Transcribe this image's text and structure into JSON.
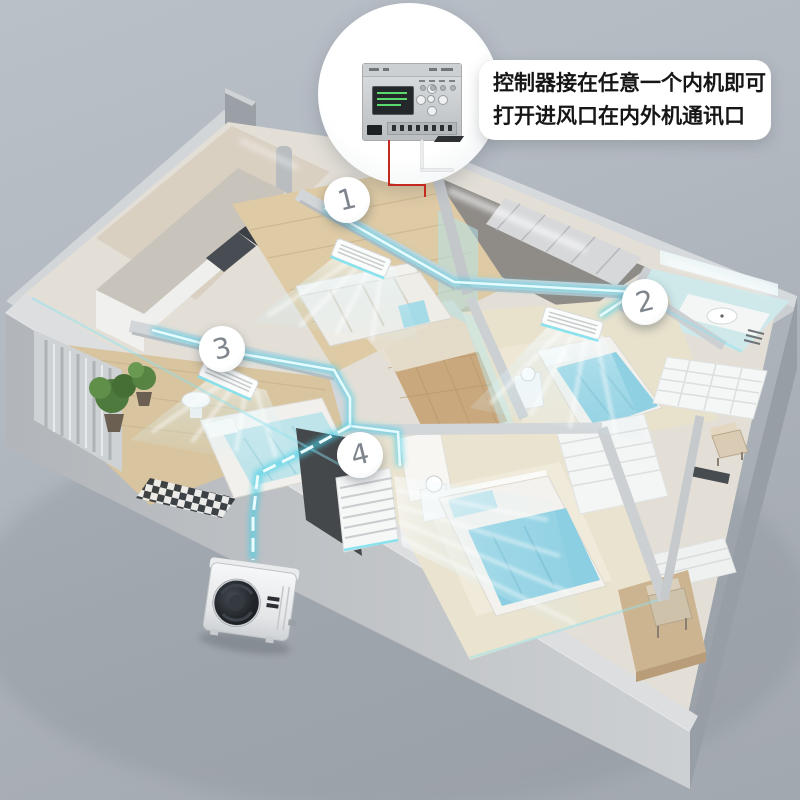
{
  "page": {
    "background_top": "#bac0c8",
    "background_bottom": "#a2a8af"
  },
  "callout": {
    "line1": "控制器接在任意一个内机即可",
    "line2": "打开进风口在内外机通讯口",
    "background": "#ffffff",
    "text_color": "#161616"
  },
  "markers": [
    {
      "label": "1"
    },
    {
      "label": "2"
    },
    {
      "label": "3"
    },
    {
      "label": "4"
    }
  ],
  "colors": {
    "pipe_glow": "#4fd2e8",
    "pipe_core": "#e9fbfe",
    "wall_light": "#d6d9dc",
    "wall_shadow": "#9aa0a6",
    "exterior_slab": "#c0c3c7",
    "floor_wood": "#d9c5a0",
    "hall_tile": "#c9a87e",
    "bed_cyan": "#8fd0e2",
    "bath_teal": "#cfe9ea",
    "air_tint": "#bfe5ea",
    "wire_red": "#c3291e",
    "wire_white": "#ecedee",
    "marker_text": "#7f858c",
    "outdoor_unit_body": "#f2f3f4",
    "outdoor_fan_dark": "#1e2226",
    "display_green": "#5ad96c"
  }
}
